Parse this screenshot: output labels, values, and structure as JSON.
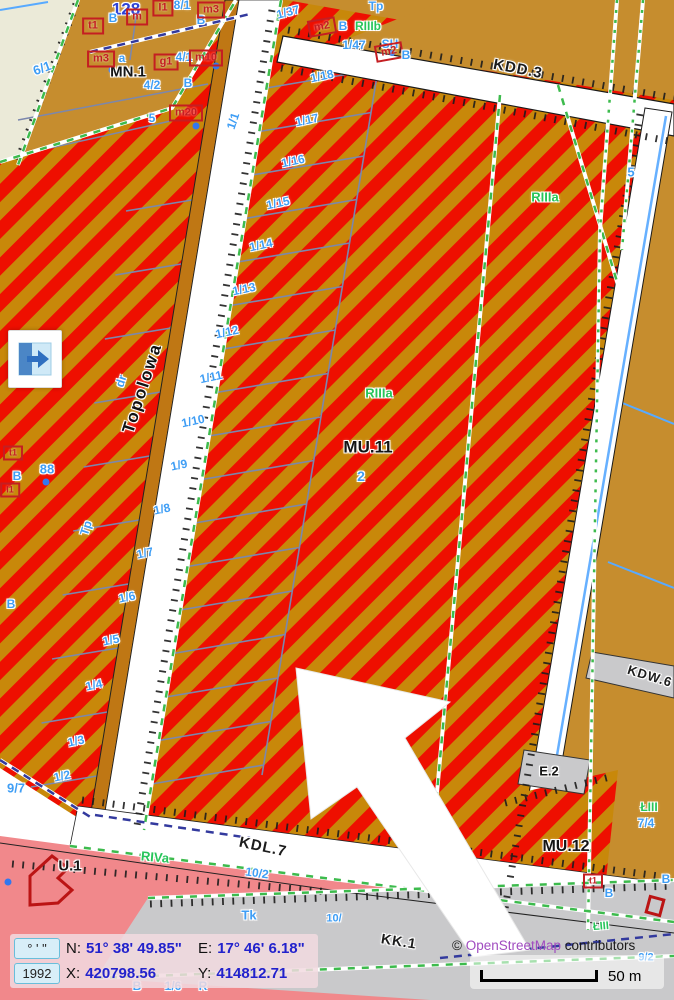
{
  "statusbar": {
    "dms_button": "° ' \"",
    "crs_button": "1992",
    "n_label": "N:",
    "n_value": "51° 38' 49.85\"",
    "e_label": "E:",
    "e_value": "17° 46' 6.18\"",
    "x_label": "X:",
    "x_value": "420798.56",
    "y_label": "Y:",
    "y_value": "414812.71"
  },
  "attribution": {
    "copyright": "© ",
    "link": "OpenStreetMap",
    "suffix": " contributors"
  },
  "scalebar": {
    "label": "50 m"
  },
  "colors": {
    "stripe_red": "#ee0f00",
    "stripe_gold": "#c8880a",
    "zone_ochre": "#c68d2e",
    "zone_pink": "#f1888b",
    "zone_gray": "#c9c9cb",
    "zone_cream": "#ebead8",
    "road_white": "#ffffff",
    "parcel_line": "#7b87ad",
    "label_blue": "#3f9ef5",
    "label_green": "#27c55a",
    "value_blue": "#2222cc",
    "osm_link": "#a14cc0"
  },
  "map": {
    "labels": [
      {
        "t": "128",
        "x": 126,
        "y": 9,
        "c": "nb"
      },
      {
        "t": "8/1",
        "x": 182,
        "y": 5,
        "c": "pb"
      },
      {
        "t": "B",
        "x": 113,
        "y": 18,
        "c": "pb"
      },
      {
        "t": "B",
        "x": 201,
        "y": 20,
        "c": "pb"
      },
      {
        "t": "m",
        "x": 137,
        "y": 17,
        "c": "red"
      },
      {
        "t": "I1",
        "x": 163,
        "y": 8,
        "c": "red"
      },
      {
        "t": "m3",
        "x": 211,
        "y": 10,
        "c": "red"
      },
      {
        "t": "t1",
        "x": 93,
        "y": 26,
        "c": "red"
      },
      {
        "t": "MN.1",
        "x": 128,
        "y": 72,
        "c": "blk",
        "fs": 15
      },
      {
        "t": "m3",
        "x": 101,
        "y": 59,
        "c": "red"
      },
      {
        "t": "a",
        "x": 122,
        "y": 58,
        "c": "pb"
      },
      {
        "t": "g1",
        "x": 166,
        "y": 62,
        "c": "red"
      },
      {
        "t": "4/1",
        "x": 184,
        "y": 57,
        "c": "pb"
      },
      {
        "t": "m10",
        "x": 206,
        "y": 58,
        "c": "red"
      },
      {
        "t": "4/2",
        "x": 152,
        "y": 85,
        "c": "pb"
      },
      {
        "t": "B",
        "x": 188,
        "y": 83,
        "c": "pb"
      },
      {
        "t": "5",
        "x": 152,
        "y": 118,
        "c": "pb"
      },
      {
        "t": "m20",
        "x": 186,
        "y": 113,
        "c": "red"
      },
      {
        "t": "6/1",
        "x": 42,
        "y": 68,
        "c": "pb",
        "r": -20,
        "fs": 13
      },
      {
        "t": "1/37",
        "x": 288,
        "y": 12,
        "c": "pb",
        "r": -15
      },
      {
        "t": "m2",
        "x": 322,
        "y": 27,
        "c": "red",
        "r": -10
      },
      {
        "t": "B",
        "x": 343,
        "y": 26,
        "c": "pb"
      },
      {
        "t": "RIIIb",
        "x": 368,
        "y": 26,
        "c": "grn"
      },
      {
        "t": "1/47",
        "x": 354,
        "y": 45,
        "c": "pb"
      },
      {
        "t": "SH",
        "x": 390,
        "y": 44,
        "c": "pb"
      },
      {
        "t": "m2",
        "x": 389,
        "y": 52,
        "c": "red",
        "r": -10
      },
      {
        "t": "B",
        "x": 406,
        "y": 55,
        "c": "pb"
      },
      {
        "t": "Tp",
        "x": 376,
        "y": 6,
        "c": "pb"
      },
      {
        "t": "1/18",
        "x": 322,
        "y": 76,
        "c": "pb",
        "r": -12
      },
      {
        "t": "1/17",
        "x": 307,
        "y": 120,
        "c": "pb",
        "r": -12
      },
      {
        "t": "1/16",
        "x": 293,
        "y": 161,
        "c": "pb",
        "r": -12
      },
      {
        "t": "1/15",
        "x": 278,
        "y": 203,
        "c": "pb",
        "r": -12
      },
      {
        "t": "1/14",
        "x": 261,
        "y": 245,
        "c": "pb",
        "r": -12
      },
      {
        "t": "1/13",
        "x": 244,
        "y": 289,
        "c": "pb",
        "r": -12
      },
      {
        "t": "1/12",
        "x": 227,
        "y": 332,
        "c": "pb",
        "r": -12
      },
      {
        "t": "1/11",
        "x": 211,
        "y": 377,
        "c": "pb",
        "r": -12
      },
      {
        "t": "1/10",
        "x": 193,
        "y": 421,
        "c": "pb",
        "r": -12
      },
      {
        "t": "1/9",
        "x": 179,
        "y": 465,
        "c": "pb",
        "r": -12
      },
      {
        "t": "1/8",
        "x": 162,
        "y": 509,
        "c": "pb",
        "r": -12
      },
      {
        "t": "1/7",
        "x": 145,
        "y": 553,
        "c": "pb",
        "r": -12
      },
      {
        "t": "1/6",
        "x": 127,
        "y": 597,
        "c": "pb",
        "r": -12
      },
      {
        "t": "1/5",
        "x": 111,
        "y": 640,
        "c": "pb",
        "r": -12
      },
      {
        "t": "1/4",
        "x": 94,
        "y": 685,
        "c": "pb",
        "r": -12
      },
      {
        "t": "1/3",
        "x": 76,
        "y": 741,
        "c": "pb",
        "r": -12
      },
      {
        "t": "1/2",
        "x": 62,
        "y": 776,
        "c": "pb",
        "r": -12
      },
      {
        "t": "1/1",
        "x": 233,
        "y": 121,
        "c": "pb",
        "r": -72
      },
      {
        "t": "Topolowa",
        "x": 142,
        "y": 388,
        "c": "street",
        "r": -72,
        "fs": 17
      },
      {
        "t": "dr",
        "x": 121,
        "y": 381,
        "c": "pb",
        "r": -72
      },
      {
        "t": "Tp",
        "x": 86,
        "y": 528,
        "c": "pb",
        "r": -72
      },
      {
        "t": "88",
        "x": 47,
        "y": 469,
        "c": "pb",
        "fs": 13
      },
      {
        "t": "B",
        "x": 17,
        "y": 476,
        "c": "pb"
      },
      {
        "t": "t1",
        "x": 13,
        "y": 453,
        "c": "red",
        "fs": 9
      },
      {
        "t": "I1",
        "x": 10,
        "y": 490,
        "c": "red",
        "fs": 9
      },
      {
        "t": "B",
        "x": 11,
        "y": 604,
        "c": "pb"
      },
      {
        "t": "9/7",
        "x": 16,
        "y": 788,
        "c": "pb",
        "fs": 13
      },
      {
        "t": "RIIIa",
        "x": 379,
        "y": 393,
        "c": "grn",
        "fs": 13
      },
      {
        "t": "MU.11",
        "x": 368,
        "y": 447,
        "c": "blk",
        "fs": 17
      },
      {
        "t": "2",
        "x": 361,
        "y": 476,
        "c": "pb",
        "fs": 14
      },
      {
        "t": "RIIIa",
        "x": 545,
        "y": 197,
        "c": "grn",
        "fs": 13
      },
      {
        "t": "5",
        "x": 631,
        "y": 172,
        "c": "pb",
        "fs": 13
      },
      {
        "t": "KDD.3",
        "x": 518,
        "y": 69,
        "c": "road",
        "r": 11,
        "fs": 15
      },
      {
        "t": "KDW.6",
        "x": 650,
        "y": 676,
        "c": "road",
        "r": 17,
        "fs": 13
      },
      {
        "t": "E.2",
        "x": 549,
        "y": 771,
        "c": "blk",
        "fs": 13
      },
      {
        "t": "ŁIII",
        "x": 649,
        "y": 807,
        "c": "grn"
      },
      {
        "t": "7/4",
        "x": 646,
        "y": 823,
        "c": "pb"
      },
      {
        "t": "MU.12",
        "x": 566,
        "y": 847,
        "c": "blk",
        "fs": 16
      },
      {
        "t": "t1",
        "x": 593,
        "y": 881,
        "c": "red",
        "fs": 9
      },
      {
        "t": "B",
        "x": 609,
        "y": 893,
        "c": "pb"
      },
      {
        "t": "B",
        "x": 666,
        "y": 879,
        "c": "pb"
      },
      {
        "t": "ŁIII",
        "x": 601,
        "y": 927,
        "c": "grn",
        "fs": 11,
        "r": -5
      },
      {
        "t": "9/2",
        "x": 646,
        "y": 958,
        "c": "pb",
        "fs": 11
      },
      {
        "t": "KDL.7",
        "x": 263,
        "y": 847,
        "c": "road",
        "r": 12,
        "fs": 15
      },
      {
        "t": "U.1",
        "x": 70,
        "y": 866,
        "c": "blk",
        "fs": 15
      },
      {
        "t": "RIVa",
        "x": 155,
        "y": 857,
        "c": "grn",
        "fs": 13,
        "r": 5
      },
      {
        "t": "10/2",
        "x": 257,
        "y": 873,
        "c": "pb",
        "r": 8
      },
      {
        "t": "Tk",
        "x": 249,
        "y": 915,
        "c": "pb",
        "fs": 13
      },
      {
        "t": "KK.1",
        "x": 399,
        "y": 941,
        "c": "road",
        "r": 9,
        "fs": 14
      },
      {
        "t": "10/",
        "x": 334,
        "y": 919,
        "c": "pb",
        "fs": 11
      },
      {
        "t": "B",
        "x": 137,
        "y": 986,
        "c": "pb"
      },
      {
        "t": "1/6",
        "x": 173,
        "y": 986,
        "c": "pb"
      },
      {
        "t": "R",
        "x": 203,
        "y": 986,
        "c": "pb"
      }
    ]
  }
}
